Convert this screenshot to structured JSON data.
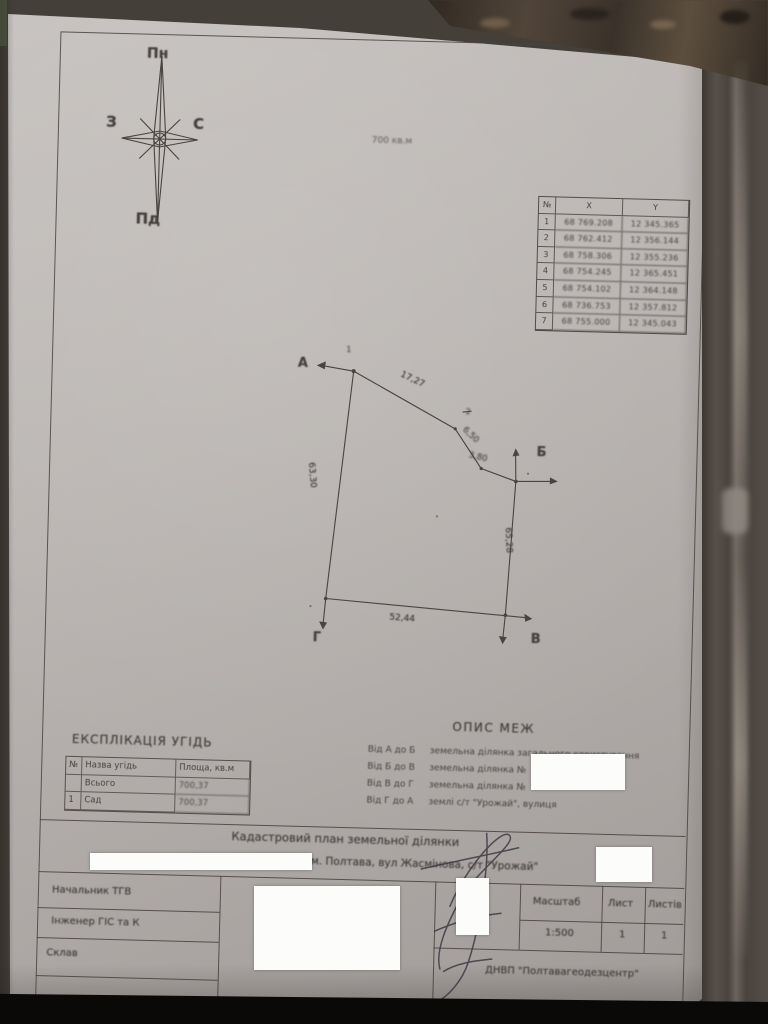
{
  "compass": {
    "north": "Пн",
    "south": "Пд",
    "west": "З",
    "east": "С"
  },
  "coord_table": {
    "headers": [
      "№",
      "X",
      "Y"
    ],
    "rows": [
      [
        "1",
        "68 769.208",
        "12 345.365"
      ],
      [
        "2",
        "68 762.412",
        "12 356.144"
      ],
      [
        "3",
        "68 758.306",
        "12 355.236"
      ],
      [
        "4",
        "68 754.245",
        "12 365.451"
      ],
      [
        "5",
        "68 754.102",
        "12 364.148"
      ],
      [
        "6",
        "68 736.753",
        "12 357.812"
      ],
      [
        "7",
        "68 755.000",
        "12 345.043"
      ]
    ]
  },
  "diagram": {
    "area_label": "700 кв.м",
    "point_a": "А",
    "point_b": "Б",
    "point_v": "В",
    "point_g": "Г",
    "vertex_1": "1",
    "vertex_2": "2",
    "len_top": "17,27",
    "len_bend1": "6,50",
    "len_bend2": "3,80",
    "len_right": "65,28",
    "len_bottom": "52,44",
    "len_left": "63,30"
  },
  "explication": {
    "heading": "ЕКСПЛІКАЦІЯ УГІДЬ",
    "headers": [
      "№",
      "Назва угідь",
      "Площа, кв.м"
    ],
    "rows": [
      [
        "",
        "Всього",
        "700,37"
      ],
      [
        "1",
        "Сад",
        "700,37"
      ]
    ]
  },
  "boundaries": {
    "heading": "ОПИС МЕЖ",
    "items": [
      {
        "from_to": "Від А до Б",
        "desc": "земельна ділянка загального користування"
      },
      {
        "from_to": "Від Б до В",
        "desc": "земельна ділянка №"
      },
      {
        "from_to": "Від В до Г",
        "desc": "земельна ділянка №"
      },
      {
        "from_to": "Від Г до А",
        "desc": "землі с/т \"Урожай\", вулиця"
      }
    ]
  },
  "title_block": {
    "title": "Кадастровий план земельної ділянки",
    "address": "м. Полтава, вул Жасмінова, с/т \"Урожай\"",
    "role_1": "Начальник ТГВ",
    "role_2": "Інженер ГІС та К",
    "role_3": "Склав",
    "scale_label": "Масштаб",
    "scale_value": "1:500",
    "sheet_label": "Лист",
    "sheet_value": "1",
    "sheets_label": "Листів",
    "sheets_value": "1",
    "org": "ДНВП \"Полтавагеодезцентр\""
  }
}
